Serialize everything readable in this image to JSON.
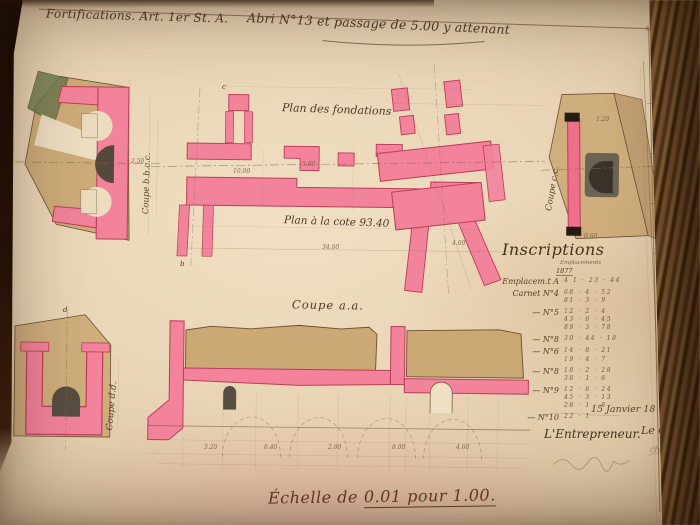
{
  "meta": {
    "folio": "69"
  },
  "header": {
    "category": "Fortifications. Art. 1er St. A.",
    "title": "Abri N°13 et passage de 5.00 y attenant"
  },
  "figures": {
    "plan_foundations_label": "Plan des fondations",
    "plan_cote_label": "Plan à la cote 93.40",
    "coupe_aa_label": "Coupe a.a.",
    "coupe_bb_label": "Coupe b.b.c.c.",
    "coupe_cc_label": "Coupe c.c.",
    "coupe_dd_label": "Coupe d.d."
  },
  "inscriptions": {
    "title": "Inscriptions",
    "col_header": "Emplacements",
    "year": "1877",
    "rows": [
      {
        "label": "Emplacem.t A",
        "nums": "4 1 · 23 · 44"
      },
      {
        "label": "Carnet N°4",
        "nums": "68 · 4 · 52\n81 · 3 · 9"
      },
      {
        "label": "— N°5",
        "nums": "12 · 2 · 4\n43 · 6 · 45\n89 · 3 · 78"
      },
      {
        "label": "— N°8",
        "nums": "30 · 44 · 18"
      },
      {
        "label": "— N°6",
        "nums": "14 · 8 · 21\n19 · 4 · 7"
      },
      {
        "label": "— N°8",
        "nums": "18 · 2 · 28\n38 · 1 · 6"
      },
      {
        "label": "— N°9",
        "nums": "12 · 6 · 24\n45 · 3 · 13\n28 · 1 · 8"
      },
      {
        "label": "— N°10",
        "nums": "22 · 1"
      }
    ],
    "date": "15 Janvier 18",
    "entrepreneur": "L'Entrepreneur.",
    "capitaine": "Le Capitaine",
    "capitaine_sub": "chef du"
  },
  "footer": {
    "scale_prefix": "Échelle de",
    "scale_value": "0.01 pour 1.00."
  },
  "dims": {
    "d0": "34.60",
    "d1": "10.00",
    "d2": "5.00",
    "d3": "4.00",
    "d4": "2.50",
    "d5": "1.20",
    "d6": "0.60",
    "d7": "3.20",
    "d8": "6.40",
    "d9": "2.00",
    "d10": "8.00",
    "d11": "4.60"
  },
  "letters": {
    "t0": "c",
    "t1": "b",
    "t2": "d"
  },
  "colors": {
    "paper": "#e8d4b5",
    "pink_wash": "#f2839b",
    "crimson_edge": "#bf3c55",
    "earth_tan": "#c6a169",
    "glacis_green": "#6f7a4e",
    "dark_masonry": "#55493a",
    "ink": "#5a4430"
  }
}
